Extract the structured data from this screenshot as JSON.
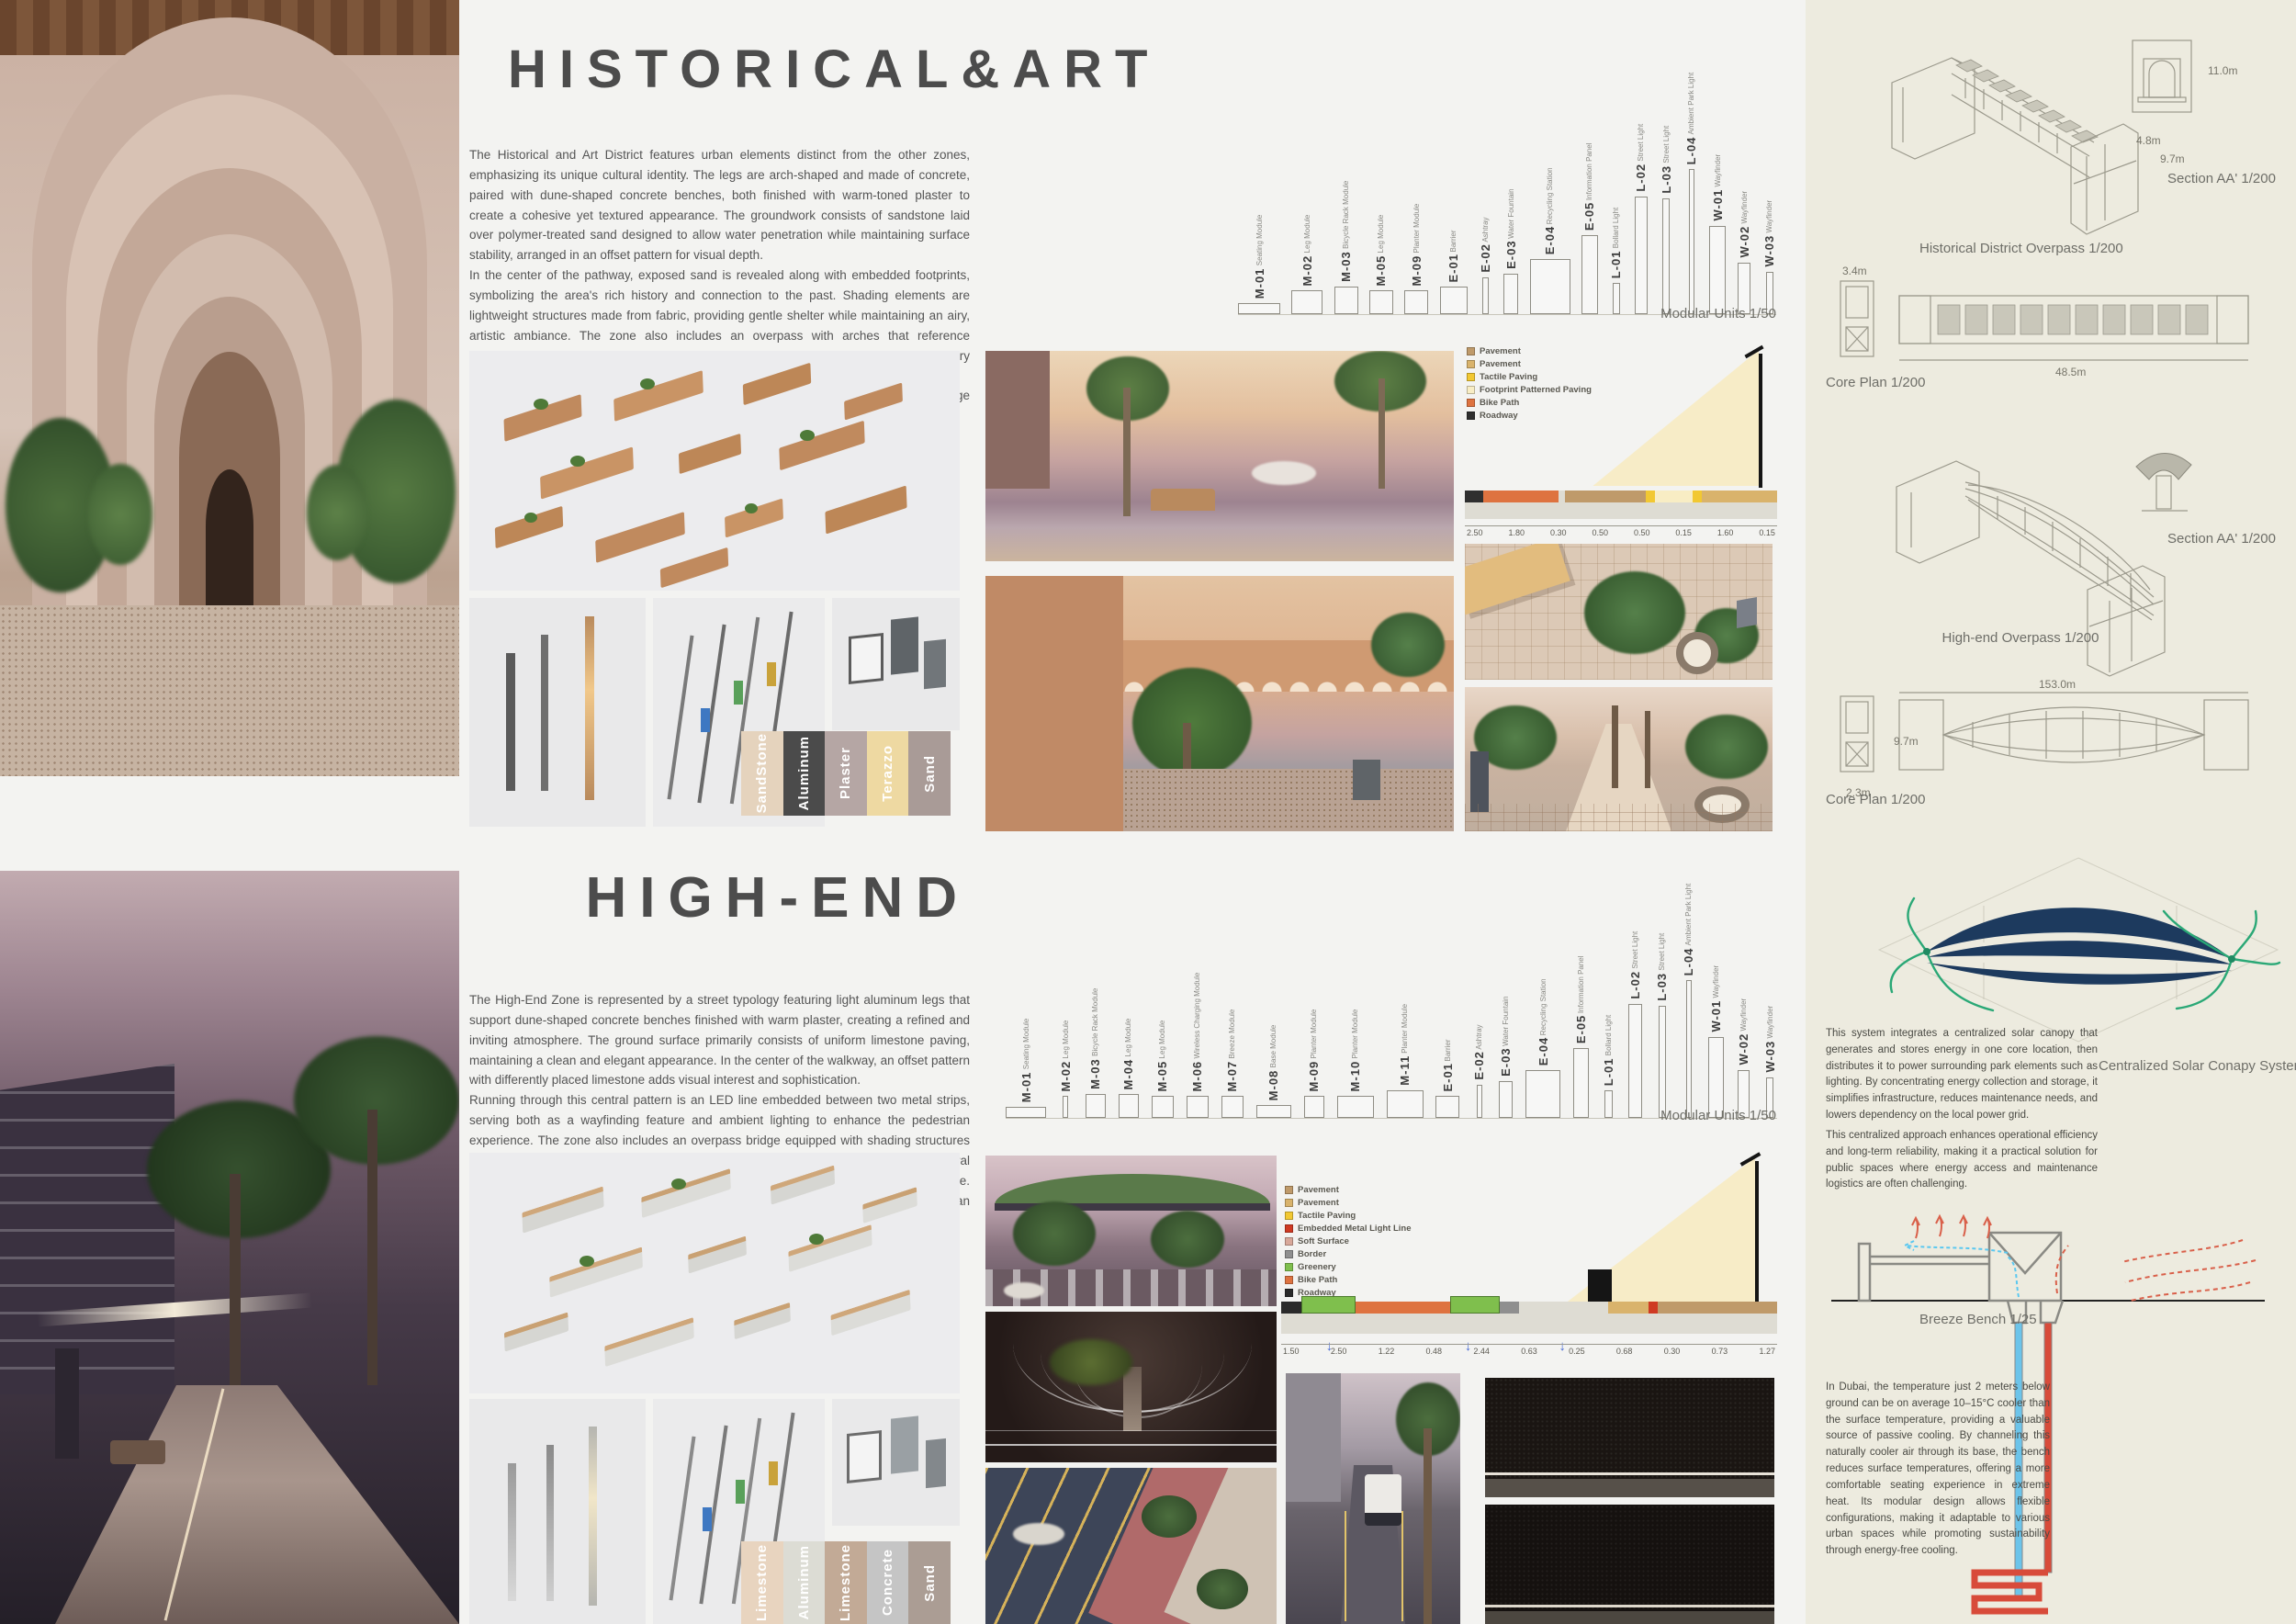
{
  "historical": {
    "title": "HISTORICAL&ART",
    "paragraph": "The Historical and Art District features urban elements distinct from the other zones, emphasizing its unique cultural identity. The legs are arch-shaped and made of concrete, paired with dune-shaped concrete benches, both finished with warm-toned plaster to create a cohesive yet textured appearance. The groundwork consists of sandstone laid over polymer-treated sand designed to allow water penetration while maintaining surface stability, arranged in an offset pattern for visual depth.\nIn the center of the pathway, exposed sand is revealed along with embedded footprints, symbolizing the area's rich history and connection to the past. Shading elements are lightweight structures made from fabric, providing gentle shelter while maintaining an airy, artistic ambiance. The zone also includes an overpass with arches that reference traditional forms but feature a modern interpretation, blending heritage with contemporary design.\nTogether, these features create a meaningful, textured environment that honors heritage while offering functional public space.",
    "modular_caption": "Modular Units 1/50",
    "modular_units": [
      {
        "code": "M-01",
        "name": "Seating Module",
        "h": 12,
        "w": 46
      },
      {
        "code": "M-02",
        "name": "Leg Module",
        "h": 26,
        "w": 34
      },
      {
        "code": "M-03",
        "name": "Bicycle Rack Module",
        "h": 30,
        "w": 26
      },
      {
        "code": "M-05",
        "name": "Leg Module",
        "h": 26,
        "w": 26
      },
      {
        "code": "M-09",
        "name": "Planter Module",
        "h": 26,
        "w": 26
      },
      {
        "code": "E-01",
        "name": "Barrier",
        "h": 30,
        "w": 30
      },
      {
        "code": "E-02",
        "name": "Ashtray",
        "h": 40,
        "w": 7
      },
      {
        "code": "E-03",
        "name": "Water Fountain",
        "h": 44,
        "w": 16
      },
      {
        "code": "E-04",
        "name": "Recycling Station",
        "h": 60,
        "w": 44
      },
      {
        "code": "E-05",
        "name": "Information Panel",
        "h": 86,
        "w": 18
      },
      {
        "code": "L-01",
        "name": "Bollard Light",
        "h": 34,
        "w": 8
      },
      {
        "code": "L-02",
        "name": "Street Light",
        "h": 128,
        "w": 14
      },
      {
        "code": "L-03",
        "name": "Street Light",
        "h": 126,
        "w": 8
      },
      {
        "code": "L-04",
        "name": "Ambient Park Light",
        "h": 158,
        "w": 6
      },
      {
        "code": "W-01",
        "name": "Wayfinder",
        "h": 96,
        "w": 18
      },
      {
        "code": "W-02",
        "name": "Wayfinder",
        "h": 56,
        "w": 14
      },
      {
        "code": "W-03",
        "name": "Wayfinder",
        "h": 46,
        "w": 8
      }
    ],
    "legend": [
      {
        "label": "Pavement",
        "color": "#bf9a6a"
      },
      {
        "label": "Pavement",
        "color": "#d9b36c"
      },
      {
        "label": "Tactile Paving",
        "color": "#f2c832"
      },
      {
        "label": "Footprint Patterned Paving",
        "color": "#f8edc4"
      },
      {
        "label": "Bike Path",
        "color": "#de7340"
      },
      {
        "label": "Roadway",
        "color": "#2f2f2f"
      }
    ],
    "section_dims": [
      "2.50",
      "1.80",
      "0.30",
      "0.50",
      "0.50",
      "0.15",
      "1.60",
      "0.15"
    ],
    "swatches": [
      {
        "label": "SandStone",
        "bg": "#e5d3bd",
        "fg": "#ffffff"
      },
      {
        "label": "Aluminum",
        "bg": "#4b4b4b",
        "fg": "#ffffff"
      },
      {
        "label": "Plaster",
        "bg": "#b5a6a4",
        "fg": "#ffffff"
      },
      {
        "label": "Terazzo",
        "bg": "#eed9a2",
        "fg": "#ffffff"
      },
      {
        "label": "Sand",
        "bg": "#a99b97",
        "fg": "#ffffff"
      }
    ]
  },
  "highend": {
    "title": "HIGH-END",
    "paragraph": "The High-End Zone is represented by a street typology featuring light aluminum legs that support dune-shaped concrete benches finished with warm plaster, creating a refined and inviting atmosphere. The ground surface primarily consists of uniform limestone paving, maintaining a clean and elegant appearance. In the center of the walkway, an offset pattern with differently placed limestone adds visual interest and sophistication.\nRunning through this central pattern is an LED line embedded between two metal strips, serving both as a wayfinding feature and ambient lighting to enhance the pedestrian experience. The zone also includes an overpass bridge equipped with shading structures that combine vegetation-covered roofs with integrated solar panels, providing both natural cooling and renewable energy benefits while maintaining a cohesive design language. Together, these elements create a luxurious, functional, and visually striking urban environment tailored to upscale living and dynamic public use.",
    "modular_caption": "Modular Units 1/50",
    "modular_units": [
      {
        "code": "M-01",
        "name": "Seating Module",
        "h": 12,
        "w": 44
      },
      {
        "code": "M-02",
        "name": "Leg Module",
        "h": 24,
        "w": 6
      },
      {
        "code": "M-03",
        "name": "Bicycle Rack Module",
        "h": 26,
        "w": 22
      },
      {
        "code": "M-04",
        "name": "Leg Module",
        "h": 26,
        "w": 22
      },
      {
        "code": "M-05",
        "name": "Leg Module",
        "h": 24,
        "w": 24
      },
      {
        "code": "M-06",
        "name": "Wireless Charging Module",
        "h": 24,
        "w": 24
      },
      {
        "code": "M-07",
        "name": "Breeze Module",
        "h": 24,
        "w": 24
      },
      {
        "code": "M-08",
        "name": "Base Module",
        "h": 14,
        "w": 38
      },
      {
        "code": "M-09",
        "name": "Planter Module",
        "h": 24,
        "w": 22
      },
      {
        "code": "M-10",
        "name": "Planter Module",
        "h": 24,
        "w": 40
      },
      {
        "code": "M-11",
        "name": "Planter Module",
        "h": 30,
        "w": 40
      },
      {
        "code": "E-01",
        "name": "Barrier",
        "h": 24,
        "w": 26
      },
      {
        "code": "E-02",
        "name": "Ashtray",
        "h": 36,
        "w": 6
      },
      {
        "code": "E-03",
        "name": "Water Fountain",
        "h": 40,
        "w": 15
      },
      {
        "code": "E-04",
        "name": "Recycling Station",
        "h": 52,
        "w": 38
      },
      {
        "code": "E-05",
        "name": "Information Panel",
        "h": 76,
        "w": 17
      },
      {
        "code": "L-01",
        "name": "Bollard Light",
        "h": 30,
        "w": 9
      },
      {
        "code": "L-02",
        "name": "Street Light",
        "h": 124,
        "w": 15
      },
      {
        "code": "L-03",
        "name": "Street Light",
        "h": 122,
        "w": 8
      },
      {
        "code": "L-04",
        "name": "Ambient Park Light",
        "h": 150,
        "w": 6
      },
      {
        "code": "W-01",
        "name": "Wayfinder",
        "h": 88,
        "w": 17
      },
      {
        "code": "W-02",
        "name": "Wayfinder",
        "h": 52,
        "w": 13
      },
      {
        "code": "W-03",
        "name": "Wayfinder",
        "h": 44,
        "w": 8
      }
    ],
    "legend": [
      {
        "label": "Pavement",
        "color": "#bf9a6a"
      },
      {
        "label": "Pavement",
        "color": "#d9b36c"
      },
      {
        "label": "Tactile Paving",
        "color": "#f2c832"
      },
      {
        "label": "Embedded Metal Light Line",
        "color": "#cf3a23"
      },
      {
        "label": "Soft Surface",
        "color": "#d8a89a"
      },
      {
        "label": "Border",
        "color": "#8f8f8f"
      },
      {
        "label": "Greenery",
        "color": "#7fbf4d"
      },
      {
        "label": "Bike Path",
        "color": "#de7340"
      },
      {
        "label": "Roadway",
        "color": "#2a2a2a"
      }
    ],
    "section_dims": [
      "1.50",
      "2.50",
      "1.22",
      "0.48",
      "2.44",
      "0.63",
      "0.25",
      "0.68",
      "0.30",
      "0.73",
      "1.27"
    ],
    "swatches": [
      {
        "label": "Limestone",
        "bg": "#e8d4bf",
        "fg": "#ffffff"
      },
      {
        "label": "Aluminum",
        "bg": "#dcdcd4",
        "fg": "#ffffff"
      },
      {
        "label": "Limestone",
        "bg": "#c2aa96",
        "fg": "#ffffff"
      },
      {
        "label": "Concrete",
        "bg": "#c5c5c5",
        "fg": "#ffffff"
      },
      {
        "label": "Sand",
        "bg": "#ab9d94",
        "fg": "#ffffff"
      }
    ]
  },
  "sidebar": {
    "section_aa_caption": "Section AA' 1/200",
    "hist_overpass_caption": "Historical District Overpass 1/200",
    "core_plan_caption": "Core Plan 1/200",
    "section_aa2_caption": "Section AA' 1/200",
    "highend_overpass_caption": "High-end Overpass 1/200",
    "core_plan2_caption": "Core Plan 1/200",
    "solar_caption": "Centralized Solar Conapy System 1/500",
    "solar_p1": "This system integrates a centralized solar canopy that generates and stores energy in one core location, then distributes it to power surrounding park elements such as lighting. By concentrating energy collection and storage, it simplifies infrastructure, reduces maintenance needs, and lowers dependency on the local power grid.",
    "solar_p2": "This centralized approach enhances operational efficiency and long-term reliability, making it a practical solution for public spaces where energy access and maintenance logistics are often challenging.",
    "breeze_caption": "Breeze Bench 1/25",
    "dubai_text": "In Dubai, the temperature just 2 meters below ground can be on average 10–15°C cooler than the surface temperature, providing a valuable source of passive cooling. By channeling this naturally cooler air through its base, the bench reduces surface temperatures, offering a more comfortable seating experience in extreme heat. Its modular design allows flexible configurations, making it adaptable to various urban spaces while promoting sustainability through energy-free cooling.",
    "dims": {
      "detail_arch": "4.8m",
      "detail_width": "9.7m",
      "detail_height": "11.0m",
      "plan1_length": "48.5m",
      "plan2_length": "153.0m",
      "core_width": "3.4m",
      "core_height": "9.7m",
      "core_base": "2.3m"
    }
  }
}
